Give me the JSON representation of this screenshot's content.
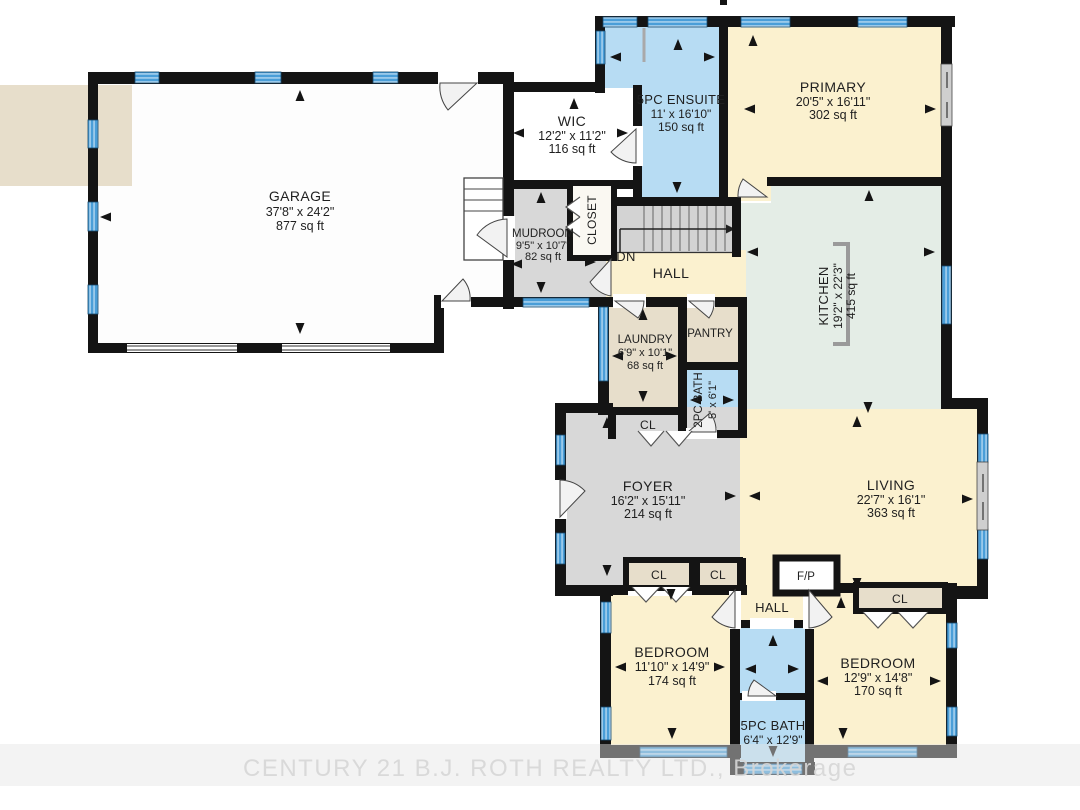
{
  "watermark": "CENTURY 21 B.J. ROTH REALTY LTD., Brokerage",
  "stairs": {
    "down_label": "DN"
  },
  "palette": {
    "cream": "#fbf1cf",
    "blue": "#b7dcf3",
    "tan": "#e7decb",
    "gray": "#d8d8d8",
    "mint": "#e4ede6",
    "white_room": "#fdfdfd",
    "wall": "#141414",
    "window": "#4a9ed8",
    "window_stripe": "#cfe6f6",
    "watermark": "#d7d7d7",
    "label": "#1f1f1f"
  },
  "rooms": {
    "garage": {
      "name": "GARAGE",
      "dims": "37'8\" x 24'2\"",
      "area": "877 sq ft"
    },
    "wic": {
      "name": "WIC",
      "dims": "12'2\" x 11'2\"",
      "area": "116 sq ft"
    },
    "ensuite_5pc": {
      "name": "5PC ENSUITE",
      "dims": "11' x 16'10\"",
      "area": "150 sq ft"
    },
    "primary": {
      "name": "PRIMARY",
      "dims": "20'5\" x 16'11\"",
      "area": "302 sq ft"
    },
    "mudroom": {
      "name": "MUDROOM",
      "dims": "9'5\" x 10'7\"",
      "area": "82 sq ft"
    },
    "closet": {
      "name": "CLOSET"
    },
    "hall_upper": {
      "name": "HALL"
    },
    "kitchen": {
      "name": "KITCHEN",
      "dims": "19'2\" x 22'3\"",
      "area": "415 sq ft"
    },
    "laundry": {
      "name": "LAUNDRY",
      "dims": "6'9\" x 10'1\"",
      "area": "68 sq ft"
    },
    "pantry": {
      "name": "PANTRY"
    },
    "bath_2pc": {
      "name": "2PC BATH",
      "dims": "5' x 6'1\""
    },
    "closet_hall": {
      "name": "CL"
    },
    "foyer": {
      "name": "FOYER",
      "dims": "16'2\" x 15'11\"",
      "area": "214 sq ft"
    },
    "living": {
      "name": "LIVING",
      "dims": "22'7\" x 16'1\"",
      "area": "363 sq ft"
    },
    "closet_foyer_left": {
      "name": "CL"
    },
    "closet_foyer_right": {
      "name": "CL"
    },
    "fireplace": {
      "name": "F/P"
    },
    "hall_lower": {
      "name": "HALL"
    },
    "closet_bedroom2": {
      "name": "CL"
    },
    "bedroom1": {
      "name": "BEDROOM",
      "dims": "11'10\" x 14'9\"",
      "area": "174 sq ft"
    },
    "bedroom2": {
      "name": "BEDROOM",
      "dims": "12'9\" x 14'8\"",
      "area": "170 sq ft"
    },
    "bath_5pc": {
      "name": "5PC BATH",
      "dims": "6'4\" x 12'9\""
    }
  }
}
